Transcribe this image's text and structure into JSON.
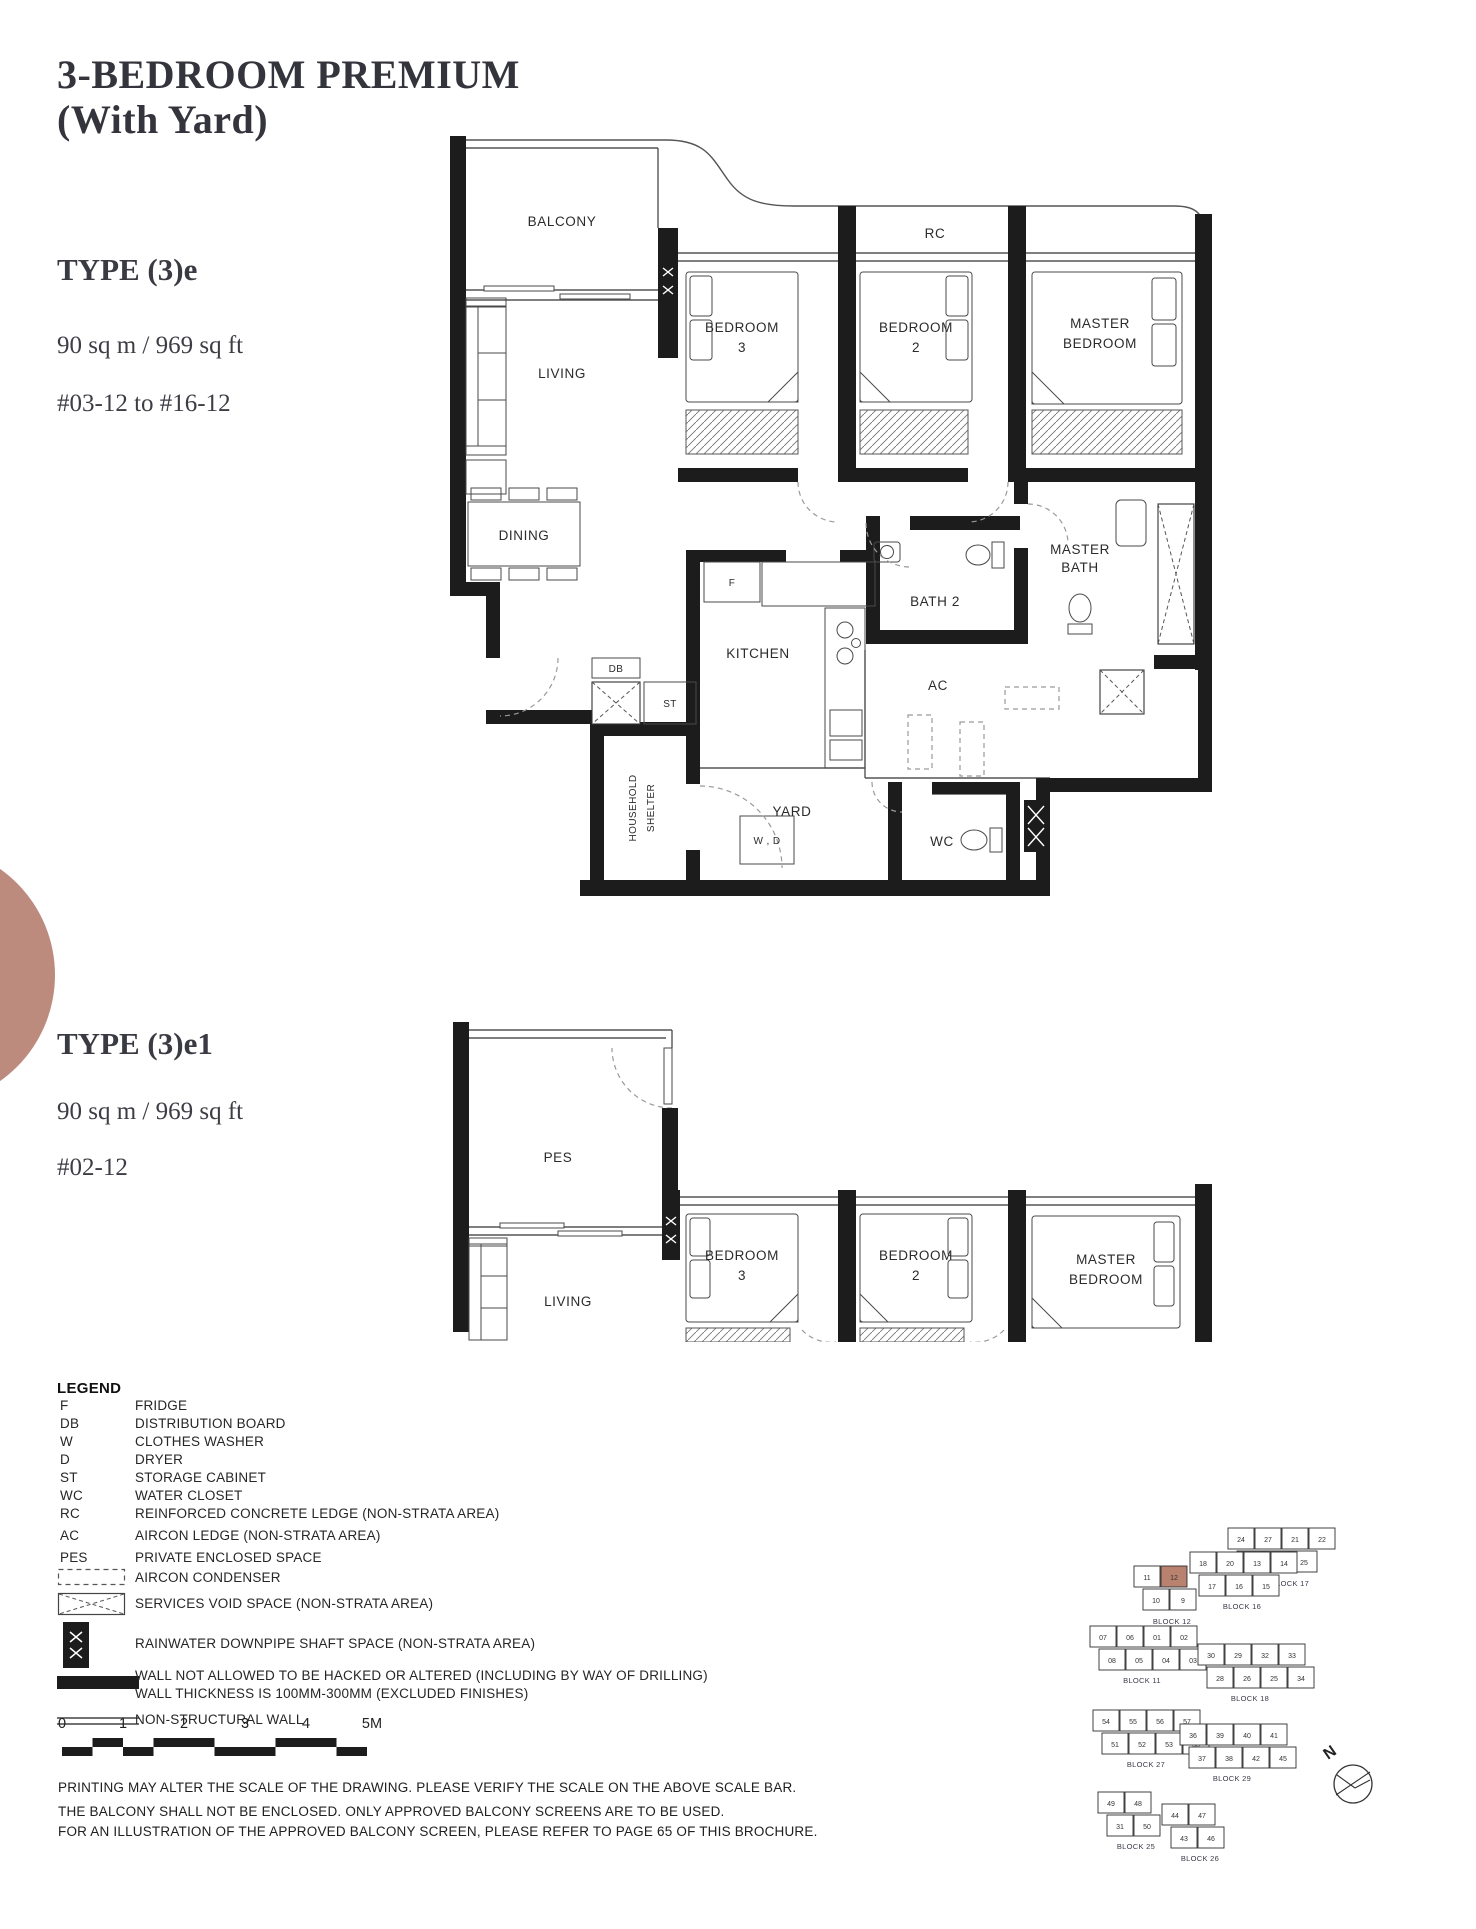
{
  "page": {
    "title": "3-BEDROOM PREMIUM\n(With Yard)",
    "accent_color": "#bd8b7e"
  },
  "unit_a": {
    "type_label": "TYPE (3)e",
    "area": "90 sq m / 969 sq ft",
    "levels": "#03-12 to #16-12"
  },
  "unit_b": {
    "type_label": "TYPE (3)e1",
    "area": "90 sq m / 969 sq ft",
    "levels": "#02-12"
  },
  "plan_a": {
    "balcony": "BALCONY",
    "rc": "RC",
    "bedroom3_1": "BEDROOM",
    "bedroom3_2": "3",
    "bedroom2_1": "BEDROOM",
    "bedroom2_2": "2",
    "master_1": "MASTER",
    "master_2": "BEDROOM",
    "living": "LIVING",
    "dining": "DINING",
    "bath2": "BATH 2",
    "master_bath_1": "MASTER",
    "master_bath_2": "BATH",
    "kitchen": "KITCHEN",
    "fridge": "F",
    "ac": "AC",
    "db": "DB",
    "st": "ST",
    "household_1": "HOUSEHOLD",
    "household_2": "SHELTER",
    "yard": "YARD",
    "wd": "W , D",
    "wc": "WC"
  },
  "plan_b": {
    "pes": "PES",
    "living": "LIVING",
    "bedroom3_1": "BEDROOM",
    "bedroom3_2": "3",
    "bedroom2_1": "BEDROOM",
    "bedroom2_2": "2",
    "master_1": "MASTER",
    "master_2": "BEDROOM"
  },
  "legend": {
    "title": "LEGEND",
    "abbrev_items": [
      {
        "abbr": "F",
        "desc": "FRIDGE"
      },
      {
        "abbr": "DB",
        "desc": "DISTRIBUTION BOARD"
      },
      {
        "abbr": "W",
        "desc": "CLOTHES WASHER"
      },
      {
        "abbr": "D",
        "desc": "DRYER"
      },
      {
        "abbr": "ST",
        "desc": "STORAGE CABINET"
      },
      {
        "abbr": "WC",
        "desc": "WATER CLOSET"
      },
      {
        "abbr": "RC",
        "desc": "REINFORCED CONCRETE LEDGE (NON-STRATA AREA)"
      },
      {
        "abbr": "AC",
        "desc": "AIRCON LEDGE (NON-STRATA AREA)"
      },
      {
        "abbr": "PES",
        "desc": "PRIVATE ENCLOSED SPACE"
      }
    ],
    "symbol_rows": [
      {
        "desc": "AIRCON CONDENSER"
      },
      {
        "desc": "SERVICES VOID SPACE (NON-STRATA AREA)"
      },
      {
        "desc": "RAINWATER DOWNPIPE SHAFT SPACE (NON-STRATA AREA)"
      },
      {
        "desc_line1": "WALL NOT ALLOWED TO BE HACKED OR ALTERED (INCLUDING BY WAY OF DRILLING)",
        "desc_line2": "WALL THICKNESS IS 100MM-300MM (EXCLUDED FINISHES)"
      },
      {
        "desc": "NON-STRUCTURAL WALL"
      }
    ]
  },
  "scalebar": {
    "labels": [
      "0",
      "1",
      "2",
      "3",
      "4",
      "5M"
    ]
  },
  "notes": [
    "PRINTING MAY ALTER THE SCALE OF THE DRAWING. PLEASE VERIFY THE SCALE ON THE ABOVE SCALE BAR.",
    "THE BALCONY SHALL NOT BE ENCLOSED. ONLY APPROVED BALCONY SCREENS ARE TO BE USED.",
    "FOR AN ILLUSTRATION OF THE APPROVED BALCONY SCREEN, PLEASE REFER TO PAGE 65 OF THIS BROCHURE."
  ],
  "sitemap": {
    "north_label": "N",
    "highlight_color": "#b9826e",
    "clusters": [
      {
        "label": "BLOCK 17",
        "x": 150,
        "y": 16,
        "lx": 212,
        "ly": 74,
        "rows": [
          [
            "24",
            "27",
            "21",
            "22"
          ],
          [
            "23",
            "26",
            "25"
          ]
        ]
      },
      {
        "label": "BLOCK 16",
        "x": 112,
        "y": 40,
        "lx": 164,
        "ly": 97,
        "rows": [
          [
            "18",
            "20",
            "13",
            "14"
          ],
          [
            "17",
            "16",
            "15"
          ]
        ]
      },
      {
        "label": "BLOCK 12",
        "x": 56,
        "y": 54,
        "lx": 94,
        "ly": 112,
        "rows": [
          [
            "11",
            "12"
          ],
          [
            "10",
            "9"
          ]
        ],
        "highlight": "12"
      },
      {
        "label": "BLOCK 11",
        "x": 12,
        "y": 114,
        "lx": 64,
        "ly": 171,
        "rows": [
          [
            "07",
            "06",
            "01",
            "02"
          ],
          [
            "08",
            "05",
            "04",
            "03"
          ]
        ]
      },
      {
        "label": "BLOCK 18",
        "x": 120,
        "y": 132,
        "lx": 172,
        "ly": 189,
        "rows": [
          [
            "30",
            "29",
            "32",
            "33"
          ],
          [
            "28",
            "26",
            "25",
            "34"
          ]
        ]
      },
      {
        "label": "BLOCK 27",
        "x": 15,
        "y": 198,
        "lx": 68,
        "ly": 255,
        "rows": [
          [
            "54",
            "55",
            "56",
            "57"
          ],
          [
            "51",
            "52",
            "53",
            "58"
          ]
        ]
      },
      {
        "label": "BLOCK 29",
        "x": 102,
        "y": 212,
        "lx": 154,
        "ly": 269,
        "rows": [
          [
            "36",
            "39",
            "40",
            "41"
          ],
          [
            "37",
            "38",
            "42",
            "45"
          ]
        ]
      },
      {
        "label": "BLOCK 25",
        "x": 20,
        "y": 280,
        "lx": 58,
        "ly": 337,
        "rows": [
          [
            "49",
            "48"
          ],
          [
            "31",
            "50"
          ]
        ]
      },
      {
        "label": "BLOCK 26",
        "x": 84,
        "y": 292,
        "lx": 122,
        "ly": 349,
        "rows": [
          [
            "44",
            "47"
          ],
          [
            "43",
            "46"
          ]
        ]
      }
    ]
  }
}
